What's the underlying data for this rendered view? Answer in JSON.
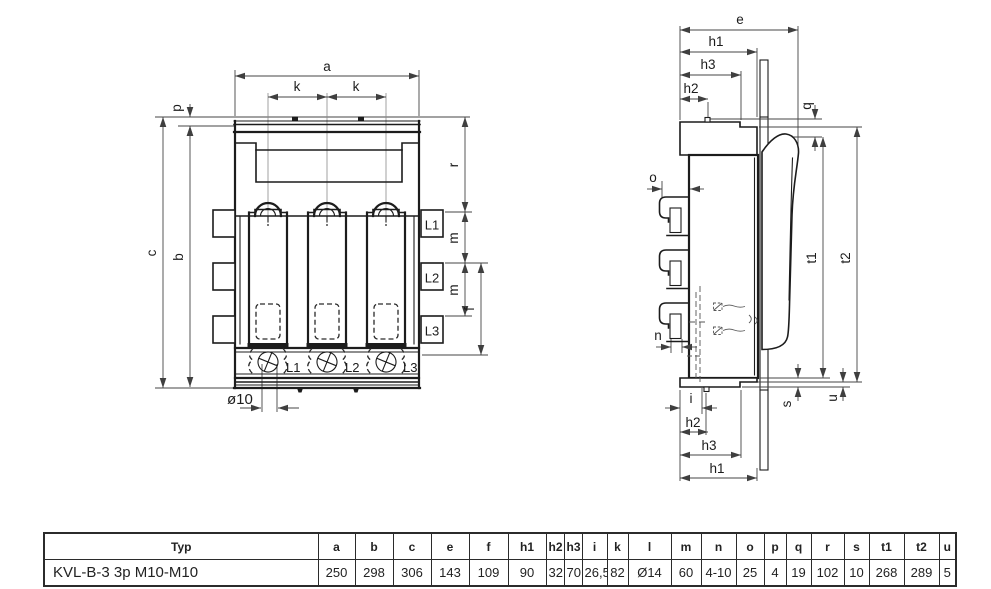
{
  "front_view": {
    "dims": {
      "a": "a",
      "k": "k",
      "p": "p",
      "c": "c",
      "b": "b",
      "r": "r",
      "m": "m",
      "f": "f",
      "dia": "ø10"
    },
    "pole_tabs": [
      "L1",
      "L2",
      "L3"
    ],
    "terminals": [
      "L1",
      "L2",
      "L3"
    ]
  },
  "side_view": {
    "dims": {
      "e": "e",
      "h1": "h1",
      "h2": "h2",
      "h3": "h3",
      "q": "q",
      "o": "o",
      "n": "n",
      "i": "i",
      "s": "s",
      "u": "u",
      "t1": "t1",
      "t2": "t2"
    }
  },
  "table": {
    "headers": [
      "Typ",
      "a",
      "b",
      "c",
      "e",
      "f",
      "h1",
      "h2",
      "h3",
      "i",
      "k",
      "l",
      "m",
      "n",
      "o",
      "p",
      "q",
      "r",
      "s",
      "t1",
      "t2",
      "u"
    ],
    "rows": [
      [
        "KVL-B-3 3p M10-M10",
        "250",
        "298",
        "306",
        "143",
        "109",
        "90",
        "32",
        "70",
        "26,5",
        "82",
        "Ø14",
        "60",
        "4-10",
        "25",
        "4",
        "19",
        "102",
        "10",
        "268",
        "289",
        "5"
      ]
    ]
  },
  "colors": {
    "ink": "#1c1c1c",
    "background": "#ffffff"
  }
}
